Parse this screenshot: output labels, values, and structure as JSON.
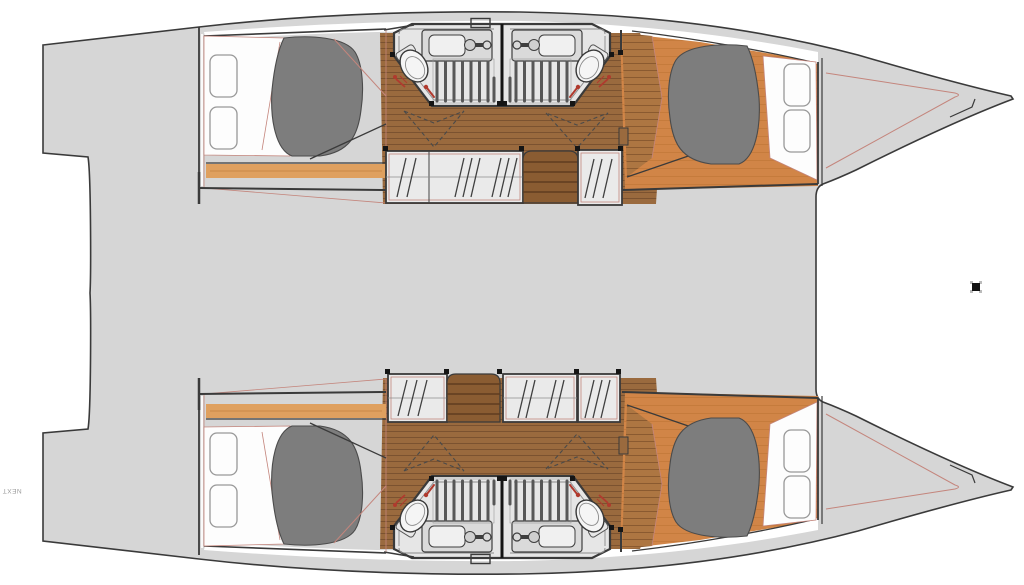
{
  "meta": {
    "title": "Catamaran interior layout floor plan",
    "type": "floor-plan",
    "view": "top-down",
    "orientation": "bow-right"
  },
  "labels": {
    "watermark": "NEXT"
  },
  "summary": {
    "hulls": 2,
    "cabins": 4,
    "bathrooms": 4,
    "double_berths": 4,
    "wardrobes": 6,
    "companionways": 2
  },
  "colors": {
    "page-bg": "#ffffff",
    "hull-gray": "#d6d6d6",
    "outline": "#3a3a3a",
    "room-fill": "#e6e6e6",
    "cabinet-fill": "#eaeaea",
    "wood-light": "#d18547",
    "wood-mid": "#ad7642",
    "wood-dark": "#9a6a3e",
    "plank-dark": "#7b5230",
    "plank-mid": "#8a5a30",
    "plank-light": "#bd7435",
    "stair-fill": "#8a5c32",
    "stair-tread": "#5f3d1f",
    "strip-light": "#dfa05f",
    "bed-gray": "#7d7d7d",
    "bed-outline": "#4b4b4b",
    "cushion-white": "#fdfdfd",
    "cushion-stroke": "#989898",
    "pink": "#c4857c",
    "red": "#b03a2e",
    "fixture-fill": "#dadada",
    "fixture-stroke": "#3e3e3e",
    "grate": "#575757",
    "dash": "#4a4a4a",
    "post": "#151515",
    "watermark": "#999999",
    "mark": "#111111"
  }
}
